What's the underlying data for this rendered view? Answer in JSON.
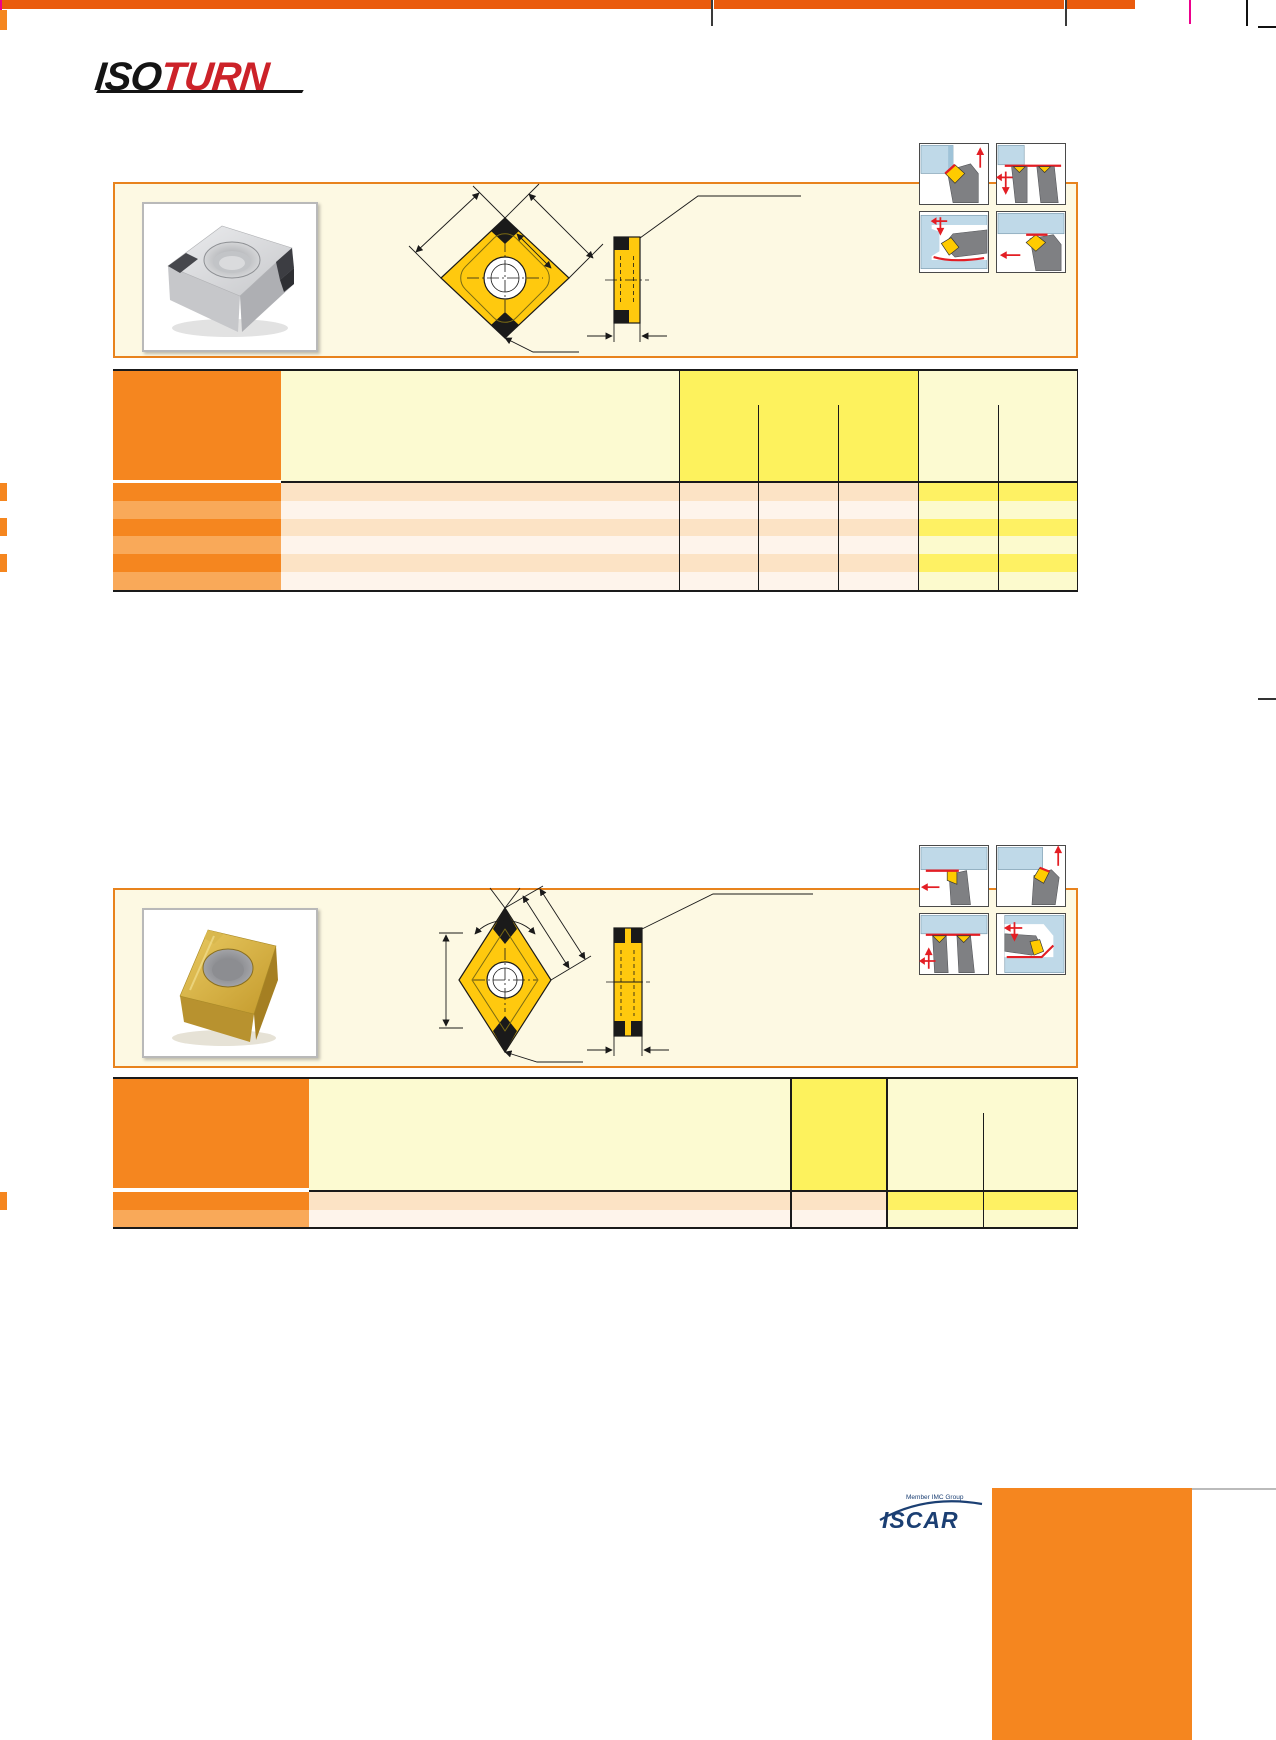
{
  "page": {
    "kind": "tooling catalog page (text-redacted)",
    "width": 1276,
    "height": 1740
  },
  "brand": {
    "logo_part1": "ISO",
    "logo_part2": "TURN"
  },
  "footer": {
    "member_text": "Member IMC Group",
    "iscar_text": "ISCAR"
  },
  "colors": {
    "top_bar": "#EA5B0D",
    "box_border": "#E8831D",
    "box_fill": "#FDF9E3",
    "header_orange": "#F5861F",
    "row_orange_light": "#F9A959",
    "row_peach": "#FCE3C5",
    "row_white": "#FEF4EB",
    "pale_yellow": "#FCFAD1",
    "bright_yellow": "#FDF25D",
    "row_yellow_bright": "#FEF163",
    "row_yellow_pale": "#FCFACD",
    "insert_yellow": "#FFC90E",
    "icon_blue": "#BFD9E8",
    "icon_gray": "#7F8083",
    "icon_red": "#E31E24",
    "iscar_navy": "#1B3F73",
    "crop_magenta": "#EC008C"
  },
  "section1": {
    "insert_type": "square/80-deg diamond insert with CBN corner tips (silver)",
    "table": {
      "header_columns": 7,
      "data_rows": 6
    }
  },
  "section2": {
    "insert_type": "55-deg diamond insert, gold coated",
    "table": {
      "header_columns": 5,
      "data_rows": 2
    }
  }
}
